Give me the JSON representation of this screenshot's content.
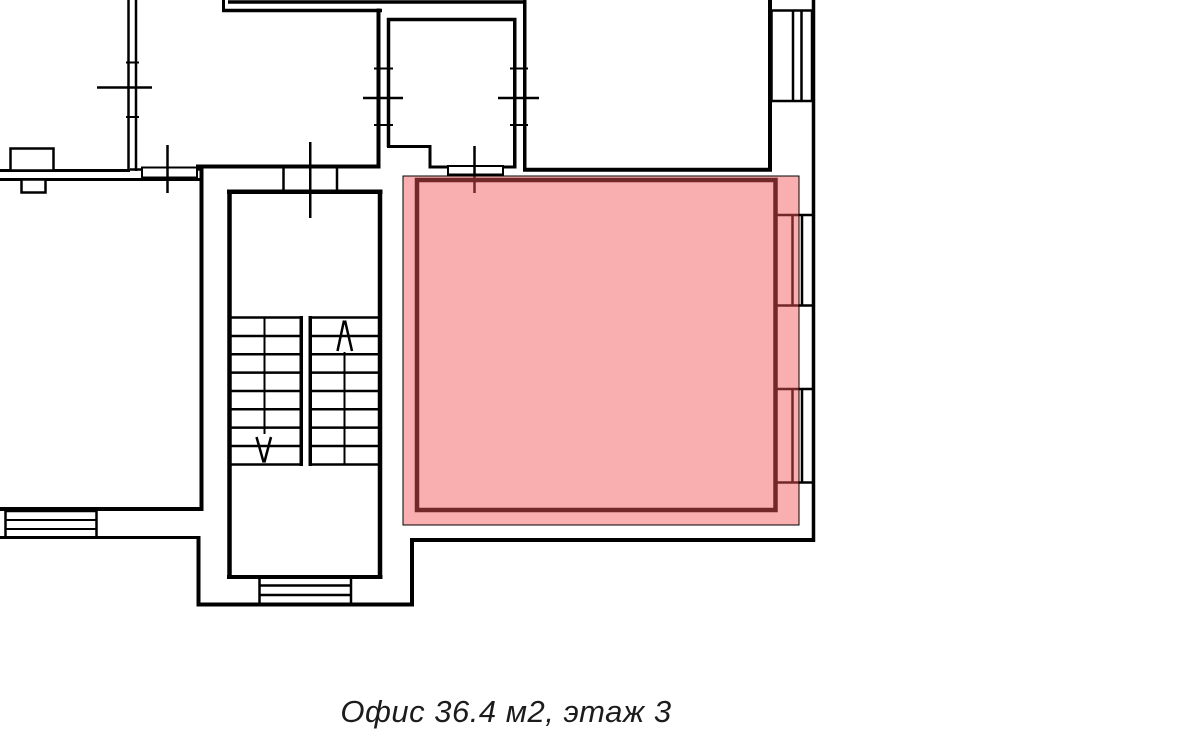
{
  "figure": {
    "caption": "Офис 36.4 м2, этаж 3",
    "office_label": "Офис",
    "area": "36.4 м2",
    "floor": "этаж 3"
  },
  "colors": {
    "line": "#000000",
    "background": "#ffffff",
    "caption_text": "#1c1c1c",
    "highlight_fill": "rgba(242,84,84,0.47)"
  }
}
